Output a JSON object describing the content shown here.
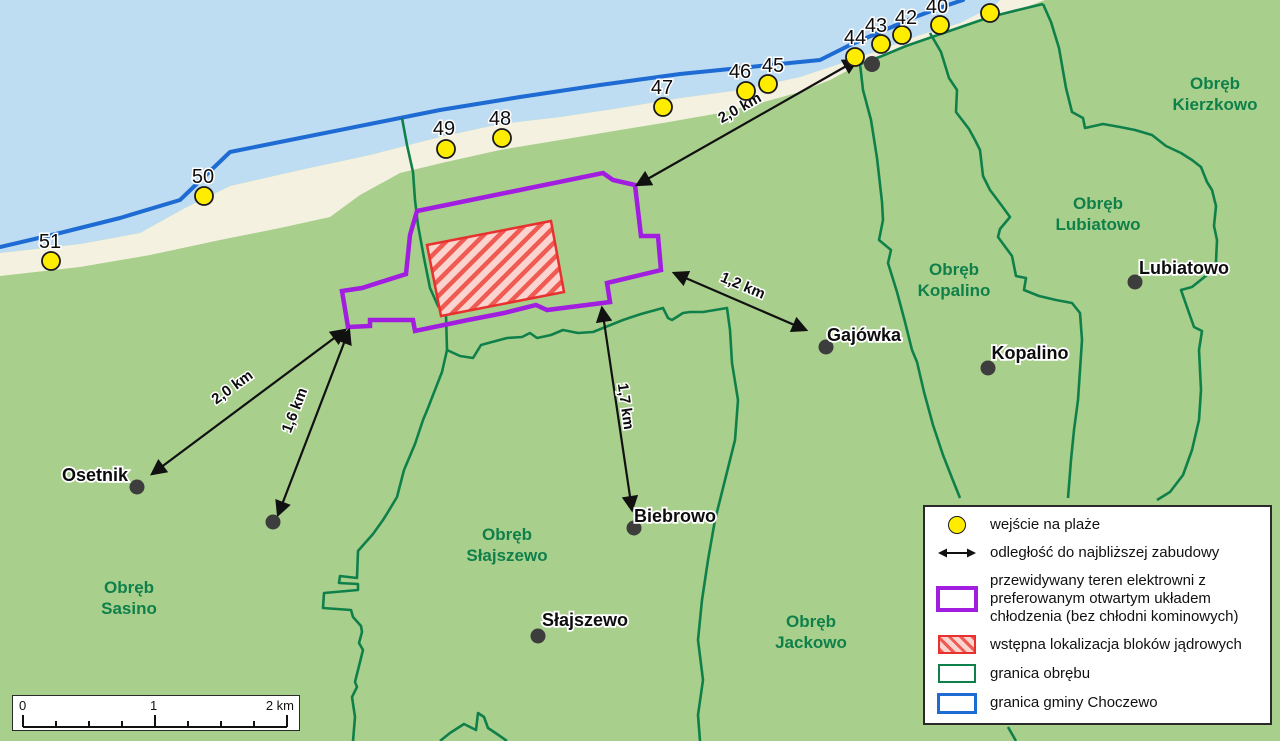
{
  "colors": {
    "water": "#bedcf2",
    "beach": "#f4f1e1",
    "land": "#a9cf8d",
    "boundary_green": "#10804a",
    "district_text_green": "#10804a",
    "gmina_blue": "#1d6bd3",
    "plant_purple": "#a11ee0",
    "blocks_red": "#e8312e",
    "blocks_fill_pink": "#fbd3cf",
    "entrance_yellow": "#ffed00",
    "marker_gray": "#3d3d3d"
  },
  "map": {
    "beach_entrances": [
      {
        "number": "40",
        "cx": 940,
        "cy": 25,
        "lx": 937,
        "ly": 13
      },
      {
        "number": "42",
        "cx": 902,
        "cy": 35,
        "lx": 906,
        "ly": 24
      },
      {
        "number": "43",
        "cx": 881,
        "cy": 44,
        "lx": 876,
        "ly": 32
      },
      {
        "number": "44",
        "cx": 855,
        "cy": 57,
        "lx": 855,
        "ly": 44
      },
      {
        "number": "45",
        "cx": 768,
        "cy": 84,
        "lx": 773,
        "ly": 72
      },
      {
        "number": "46",
        "cx": 746,
        "cy": 91,
        "lx": 740,
        "ly": 78
      },
      {
        "number": "47",
        "cx": 663,
        "cy": 107,
        "lx": 662,
        "ly": 94
      },
      {
        "number": "48",
        "cx": 502,
        "cy": 138,
        "lx": 500,
        "ly": 125
      },
      {
        "number": "49",
        "cx": 446,
        "cy": 149,
        "lx": 444,
        "ly": 135
      },
      {
        "number": "50",
        "cx": 204,
        "cy": 196,
        "lx": 203,
        "ly": 183
      },
      {
        "number": "51",
        "cx": 51,
        "cy": 261,
        "lx": 50,
        "ly": 248
      }
    ],
    "unlabeled_entrance": {
      "cx": 990,
      "cy": 13
    },
    "settlements": [
      {
        "name": "Osetnik",
        "cx": 137,
        "cy": 487,
        "lx": 95,
        "ly": 481
      },
      {
        "name": "Gajówka",
        "cx": 826,
        "cy": 347,
        "lx": 864,
        "ly": 341
      },
      {
        "name": "Biebrowo",
        "cx": 634,
        "cy": 528,
        "lx": 675,
        "ly": 522
      },
      {
        "name": "Słajszewo",
        "cx": 538,
        "cy": 636,
        "lx": 585,
        "ly": 626
      },
      {
        "name": "Kopalino",
        "cx": 988,
        "cy": 368,
        "lx": 1030,
        "ly": 359
      },
      {
        "name": "Lubiatowo",
        "cx": 1135,
        "cy": 282,
        "lx": 1184,
        "ly": 274
      }
    ],
    "building_markers": [
      {
        "cx": 872,
        "cy": 64
      },
      {
        "cx": 273,
        "cy": 522
      }
    ],
    "districts": [
      {
        "line1": "Obręb",
        "line2": "Sasino",
        "x": 129,
        "y1": 593,
        "y2": 614
      },
      {
        "line1": "Obręb",
        "line2": "Słajszewo",
        "x": 507,
        "y1": 540,
        "y2": 561
      },
      {
        "line1": "Obręb",
        "line2": "Jackowo",
        "x": 811,
        "y1": 627,
        "y2": 648
      },
      {
        "line1": "Obręb",
        "line2": "Kopalino",
        "x": 954,
        "y1": 275,
        "y2": 296
      },
      {
        "line1": "Obręb",
        "line2": "Lubiatowo",
        "x": 1098,
        "y1": 209,
        "y2": 230
      },
      {
        "line1": "Obręb",
        "line2": "Kierzkowo",
        "x": 1215,
        "y1": 89,
        "y2": 110
      }
    ],
    "distances": [
      {
        "label": "2,0 km",
        "x1": 637,
        "y1": 185,
        "x2": 857,
        "y2": 60,
        "tx": 742,
        "ty": 112,
        "transform": "rotate(-29 742 112)"
      },
      {
        "label": "1,2 km",
        "x1": 674,
        "y1": 273,
        "x2": 806,
        "y2": 330,
        "tx": 741,
        "ty": 290,
        "transform": "rotate(23 741 290)"
      },
      {
        "label": "1,7 km",
        "x1": 602,
        "y1": 308,
        "x2": 632,
        "y2": 510,
        "tx": 621,
        "ty": 407,
        "transform": "rotate(82 621 407)"
      },
      {
        "label": "1,6 km",
        "x1": 349,
        "y1": 330,
        "x2": 278,
        "y2": 515,
        "tx": 299,
        "ty": 412,
        "transform": "rotate(-69 299 412)"
      },
      {
        "label": "2,0 km",
        "x1": 345,
        "y1": 330,
        "x2": 152,
        "y2": 474,
        "tx": 235,
        "ty": 391,
        "transform": "rotate(-36 235 391)"
      }
    ]
  },
  "legend": {
    "items": [
      {
        "label": "wejście na plaże"
      },
      {
        "label": "odległość do najbliższej zabudowy"
      },
      {
        "lines": [
          "przewidywany teren elektrowni z",
          "preferowanym otwartym układem",
          "chłodzenia (bez chłodni kominowych)"
        ]
      },
      {
        "label": "wstępna lokalizacja bloków jądrowych"
      },
      {
        "label": "granica obrębu"
      },
      {
        "label": "granica gminy Choczewo"
      }
    ]
  },
  "scalebar": {
    "label0": "0",
    "label1": "1",
    "label2": "2 km"
  }
}
